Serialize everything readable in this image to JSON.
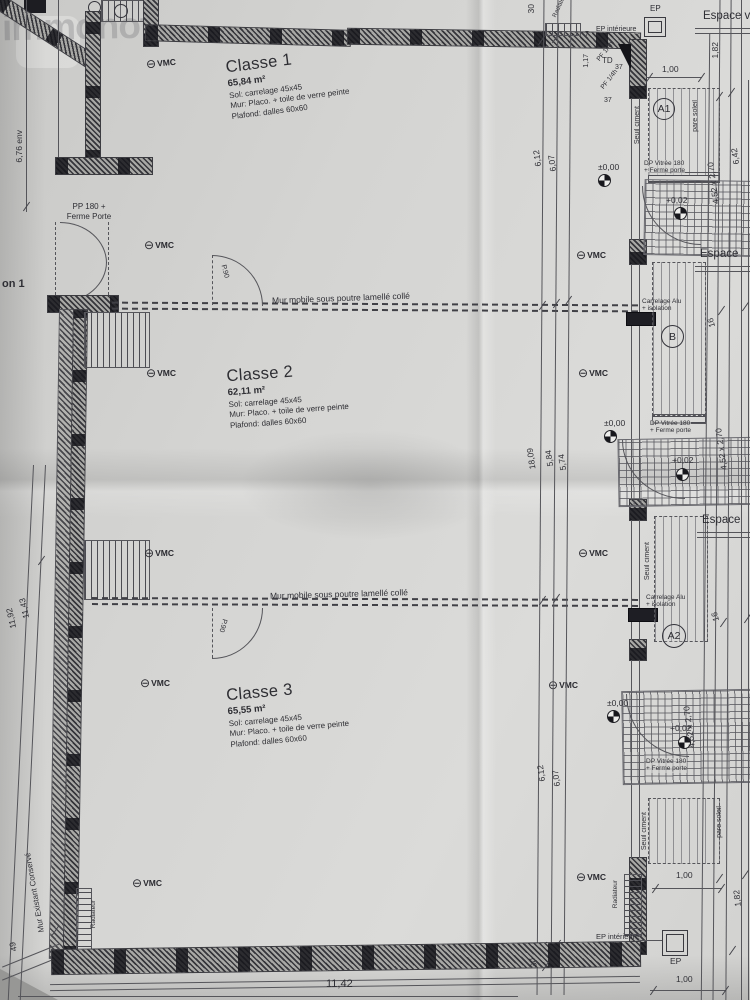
{
  "watermark": "immonot",
  "rooms": [
    {
      "name": "Classe 1",
      "area": "65,84 m²",
      "sol": "Sol: carrelage 45x45",
      "mur": "Mur: Placo. + toile de verre peinte",
      "plafond": "Plafond: dalles 60x60"
    },
    {
      "name": "Classe 2",
      "area": "62,11 m²",
      "sol": "Sol: carrelage 45x45",
      "mur": "Mur: Placo. + toile de verre peinte",
      "plafond": "Plafond: dalles 60x60"
    },
    {
      "name": "Classe 3",
      "area": "65,55 m²",
      "sol": "Sol: carrelage 45x45",
      "mur": "Mur: Placo. + toile de verre peinte",
      "plafond": "Plafond: dalles 60x60"
    }
  ],
  "labels": {
    "mur_mobile": "Mur mobile sous poutre lamellé collé",
    "pp180_l1": "PP 180 +",
    "pp180_l2": "Ferme Porte",
    "mur_existant": "Mur Existant Conservé",
    "vmc": "VMC",
    "espace_ve": "Espace ve",
    "espace": "Espace",
    "seuil_ciment": "Seuil ciment",
    "pare_soleil": "pare soleil",
    "carrelage_l1": "Carrelage Alu",
    "carrelage_l2": "+ isolation",
    "dp_vitree_l1": "DP Vitrée 180",
    "dp_vitree_l2": "+ Ferme porte",
    "ep": "EP",
    "ep_interieure": "EP intérieure",
    "radiateur": "Radiateur",
    "td": "TD",
    "pf14h": "PF 1/4h",
    "p90": "P.90",
    "circulation_partial": "on 1"
  },
  "icons": {
    "vmc_symbol": "⊖"
  },
  "zones": {
    "a1": "A1",
    "b": "B",
    "a2": "A2"
  },
  "levels": {
    "zero": "±0,00",
    "plus2": "+0,02"
  },
  "dims": {
    "env676": "6,76 env",
    "d612": "6,12",
    "d607": "6,07",
    "d1809": "18,09",
    "d584": "5,84",
    "d574": "5,74",
    "d1192": "11,92",
    "d1143": "11,43",
    "d1142": "11,42",
    "d49": "49",
    "d30": "30",
    "d100": "1,00",
    "d182": "1,82",
    "d642": "6,42",
    "d452": "4,52 x 2,70",
    "d16": "16",
    "d37": "37",
    "d117": "1,17",
    "d7": "7"
  }
}
